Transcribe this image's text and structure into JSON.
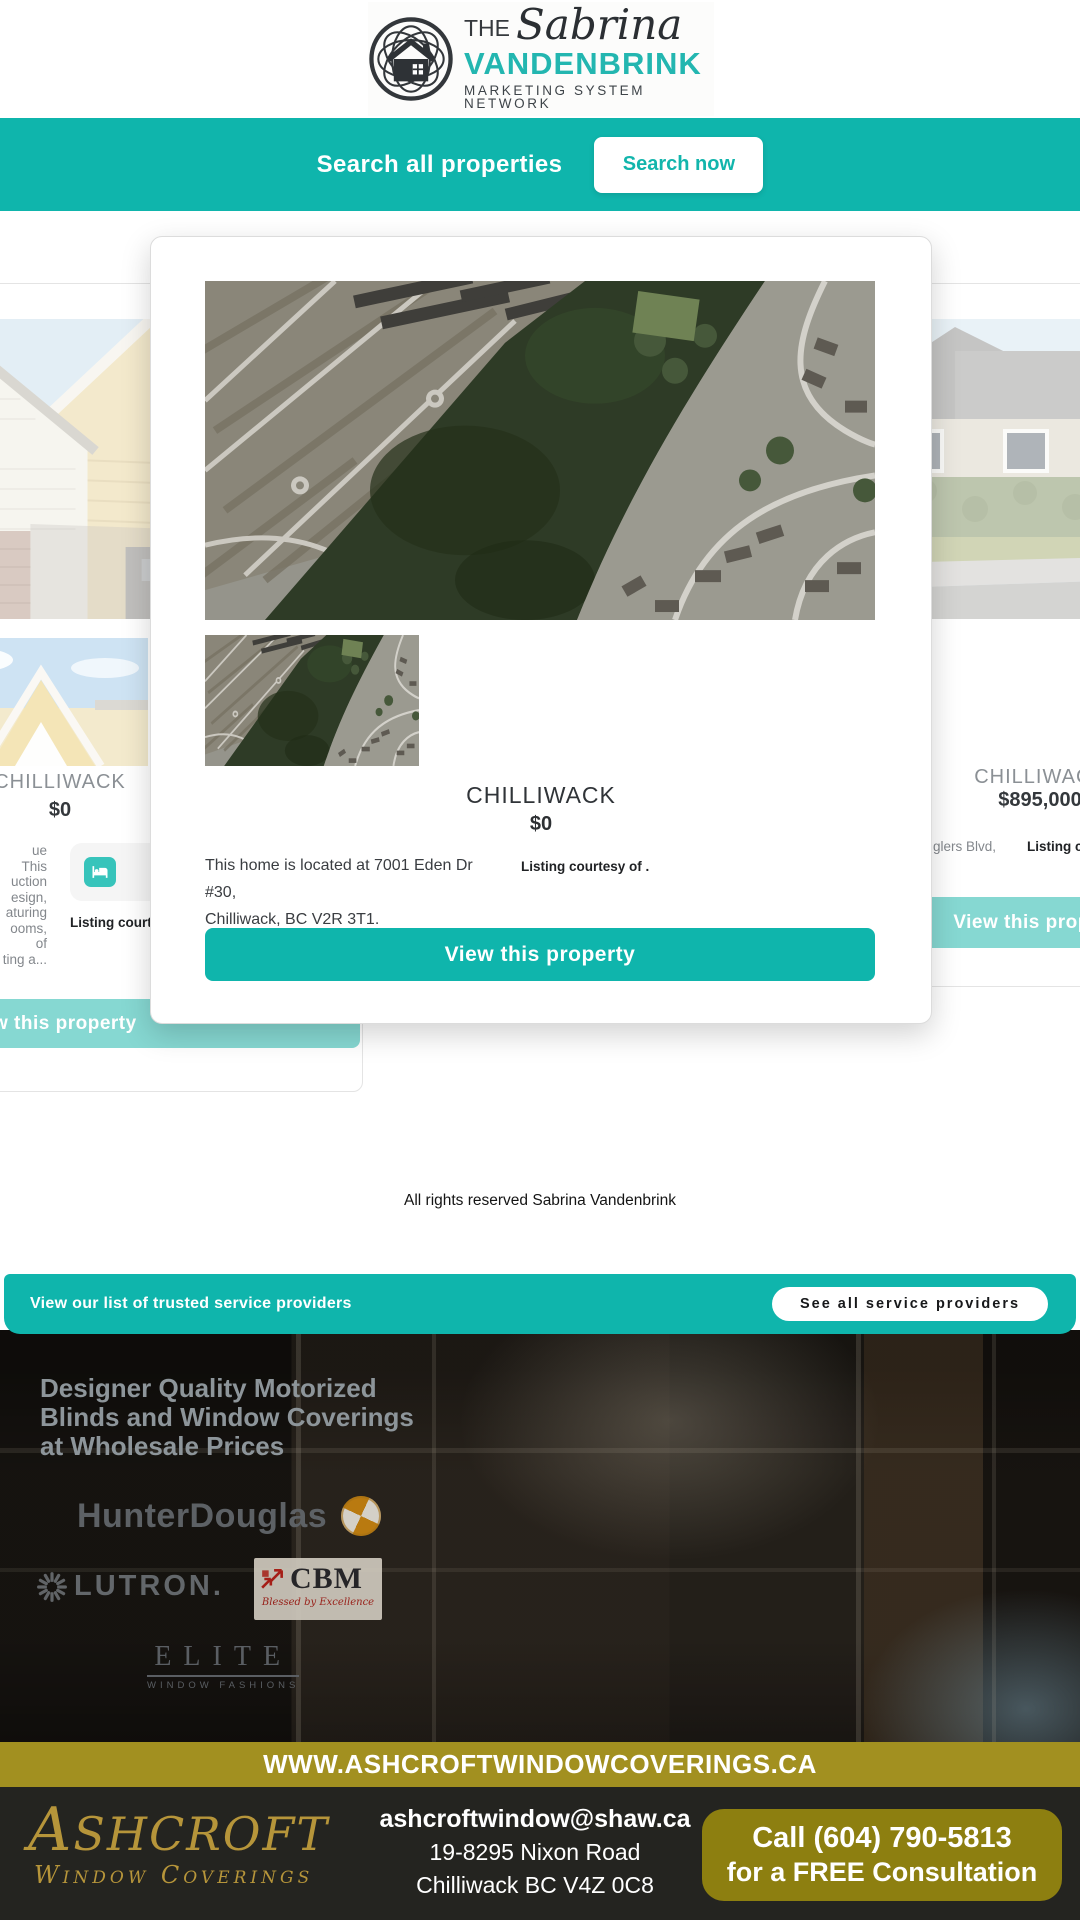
{
  "header": {
    "logo_the": "THE",
    "logo_name": "Sabrina",
    "logo_surname": "VANDENBRINK",
    "logo_tagline": "MARKETING SYSTEM NETWORK"
  },
  "search_banner": {
    "label": "Search all properties",
    "button_label": "Search now"
  },
  "modal": {
    "city": "CHILLIWACK",
    "price": "$0",
    "description_line1": "This home is located at 7001 Eden Dr #30,",
    "description_line2": "Chilliwack, BC V2R 3T1.",
    "listing_courtesy": "Listing courtesy of .",
    "button_label": "View this property"
  },
  "left_card": {
    "city": "CHILLIWACK",
    "price": "$0",
    "description_lines": [
      "ue",
      "This",
      "uction",
      "esign,",
      "aturing",
      "ooms,",
      "of",
      "ting a..."
    ],
    "beds_count": "4",
    "listing_courtesy": "Listing courtesy of .",
    "button_label": "View this property"
  },
  "right_card": {
    "city": "CHILLIWACK",
    "price": "$895,000",
    "description_fragment": "glers Blvd,",
    "listing_courtesy": "Listing courtesy of .",
    "button_label": "View this property"
  },
  "footer_note": "All rights reserved Sabrina Vandenbrink",
  "providers_bar": {
    "label": "View our list of trusted service providers",
    "button_label": "See all service providers"
  },
  "ad": {
    "headline_line1": "Designer Quality Motorized",
    "headline_line2": "Blinds and Window Coverings",
    "headline_line3": "at Wholesale Prices",
    "brand_hunter": "HunterDouglas",
    "brand_lutron": "LUTRON.",
    "brand_cbm": "CBM",
    "brand_cbm_tagline": "Blessed by Excellence",
    "brand_elite": "ELITE",
    "brand_elite_sub": "WINDOW FASHIONS",
    "website": "WWW.ASHCROFTWINDOWCOVERINGS.CA",
    "company_initial": "A",
    "company_rest": "SHCROFT",
    "company_sub": "Window Coverings",
    "email": "ashcroftwindow@shaw.ca",
    "address_line1": "19-8295 Nixon Road",
    "address_line2": "Chilliwack BC V4Z 0C8",
    "call_line1": "Call  (604) 790-5813",
    "call_line2": "for a FREE Consultation"
  },
  "colors": {
    "teal": "#0fb5ac",
    "teal_light": "#86d8d2",
    "gold_bar": "#a29020",
    "gold_button": "#8d7f10",
    "gold_text": "#b6953a"
  }
}
